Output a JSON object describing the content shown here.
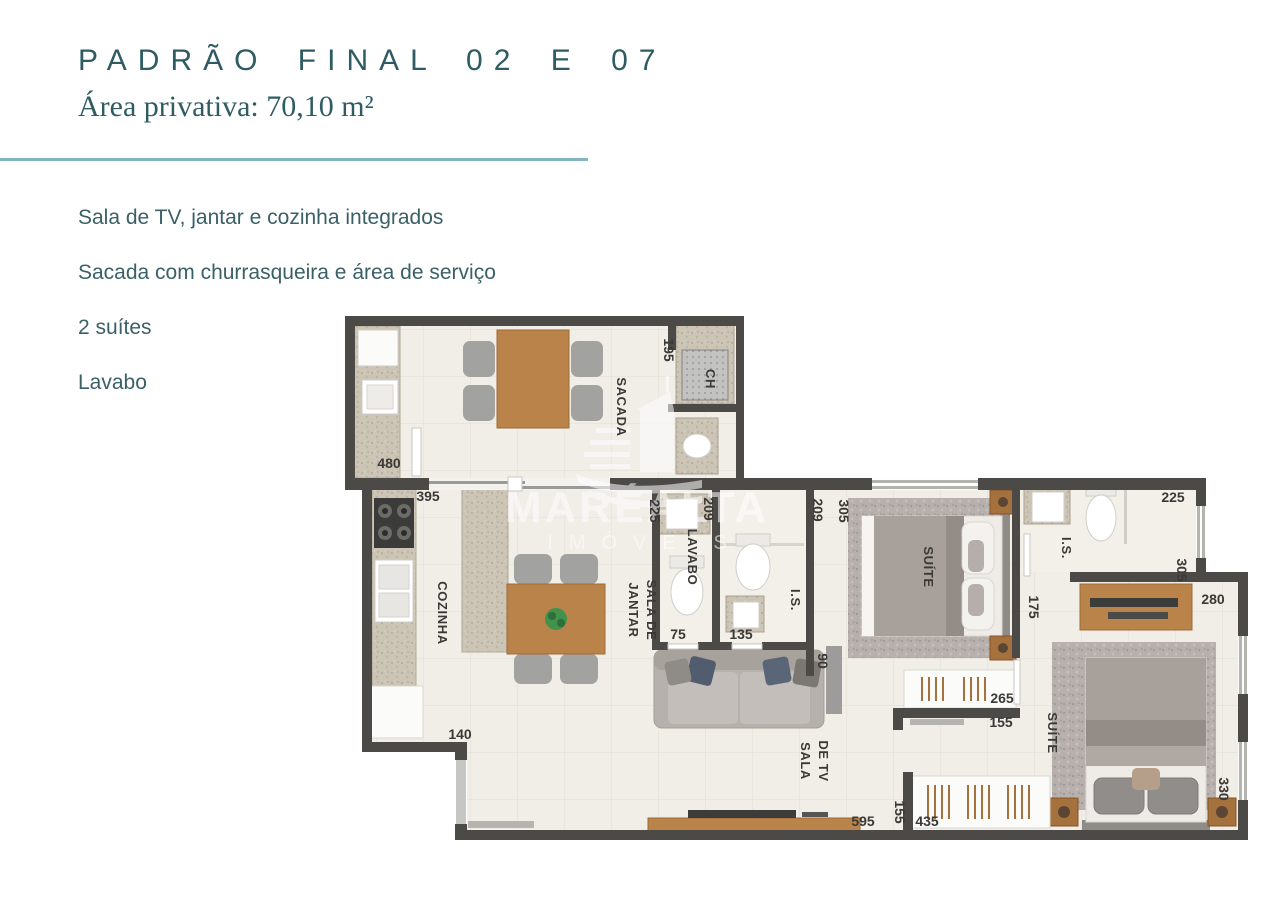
{
  "header": {
    "title": "PADRÃO FINAL 02 E 07",
    "subtitle": "Área privativa: 70,10 m²"
  },
  "features": [
    "Sala de TV, jantar e cozinha integrados",
    "Sacada com churrasqueira e área de serviço",
    "2 suítes",
    "Lavabo"
  ],
  "watermark": {
    "brand": "MARÉALTA",
    "sub": "IMÓVEIS"
  },
  "colors": {
    "title_teal": "#2f5c63",
    "divider_teal": "#84b5be",
    "feature_text": "#3a6067",
    "wall": "#4b4a47",
    "floor": "#f1ede7",
    "wood": "#b9834a",
    "label": "#3a3936"
  },
  "floorplan": {
    "room_labels": [
      {
        "text": "SACADA",
        "x": 617,
        "y": 407,
        "rot": 90,
        "fs": 13
      },
      {
        "text": "CH",
        "x": 706,
        "y": 379,
        "rot": 90,
        "fs": 12
      },
      {
        "text": "COZINHA",
        "x": 438,
        "y": 613,
        "rot": 90,
        "fs": 13
      },
      {
        "text": "SALA DE",
        "x": 647,
        "y": 610,
        "rot": 90,
        "fs": 12
      },
      {
        "text": "JANTAR",
        "x": 629,
        "y": 610,
        "rot": 90,
        "fs": 12
      },
      {
        "text": "LAVABO",
        "x": 688,
        "y": 557,
        "rot": 90,
        "fs": 12
      },
      {
        "text": "I.S.",
        "x": 791,
        "y": 600,
        "rot": 90,
        "fs": 12
      },
      {
        "text": "SUÍTE",
        "x": 924,
        "y": 567,
        "rot": 90,
        "fs": 13
      },
      {
        "text": "I.S.",
        "x": 1062,
        "y": 548,
        "rot": 90,
        "fs": 12
      },
      {
        "text": "SUÍTE",
        "x": 1048,
        "y": 733,
        "rot": 90,
        "fs": 13
      },
      {
        "text": "SALA",
        "x": 801,
        "y": 761,
        "rot": 90,
        "fs": 12
      },
      {
        "text": "DE TV",
        "x": 819,
        "y": 761,
        "rot": 90,
        "fs": 12
      }
    ],
    "dimension_labels": [
      {
        "text": "480",
        "x": 389,
        "y": 468,
        "rot": 0
      },
      {
        "text": "195",
        "x": 664,
        "y": 350,
        "rot": 90
      },
      {
        "text": "395",
        "x": 428,
        "y": 501,
        "rot": 0
      },
      {
        "text": "225",
        "x": 650,
        "y": 511,
        "rot": 90
      },
      {
        "text": "209",
        "x": 704,
        "y": 509,
        "rot": 90
      },
      {
        "text": "75",
        "x": 678,
        "y": 639,
        "rot": 0
      },
      {
        "text": "135",
        "x": 741,
        "y": 639,
        "rot": 0
      },
      {
        "text": "209",
        "x": 813,
        "y": 510,
        "rot": 90
      },
      {
        "text": "305",
        "x": 839,
        "y": 511,
        "rot": 90
      },
      {
        "text": "90",
        "x": 818,
        "y": 661,
        "rot": 90
      },
      {
        "text": "175",
        "x": 1029,
        "y": 607,
        "rot": 90
      },
      {
        "text": "265",
        "x": 1002,
        "y": 703,
        "rot": 0
      },
      {
        "text": "155",
        "x": 1001,
        "y": 727,
        "rot": 0
      },
      {
        "text": "225",
        "x": 1173,
        "y": 502,
        "rot": 0
      },
      {
        "text": "305",
        "x": 1177,
        "y": 570,
        "rot": 90
      },
      {
        "text": "280",
        "x": 1213,
        "y": 604,
        "rot": 0
      },
      {
        "text": "140",
        "x": 460,
        "y": 739,
        "rot": 0
      },
      {
        "text": "595",
        "x": 863,
        "y": 826,
        "rot": 0
      },
      {
        "text": "155",
        "x": 895,
        "y": 812,
        "rot": 90
      },
      {
        "text": "435",
        "x": 927,
        "y": 826,
        "rot": 0
      },
      {
        "text": "330",
        "x": 1219,
        "y": 789,
        "rot": 90
      }
    ]
  }
}
